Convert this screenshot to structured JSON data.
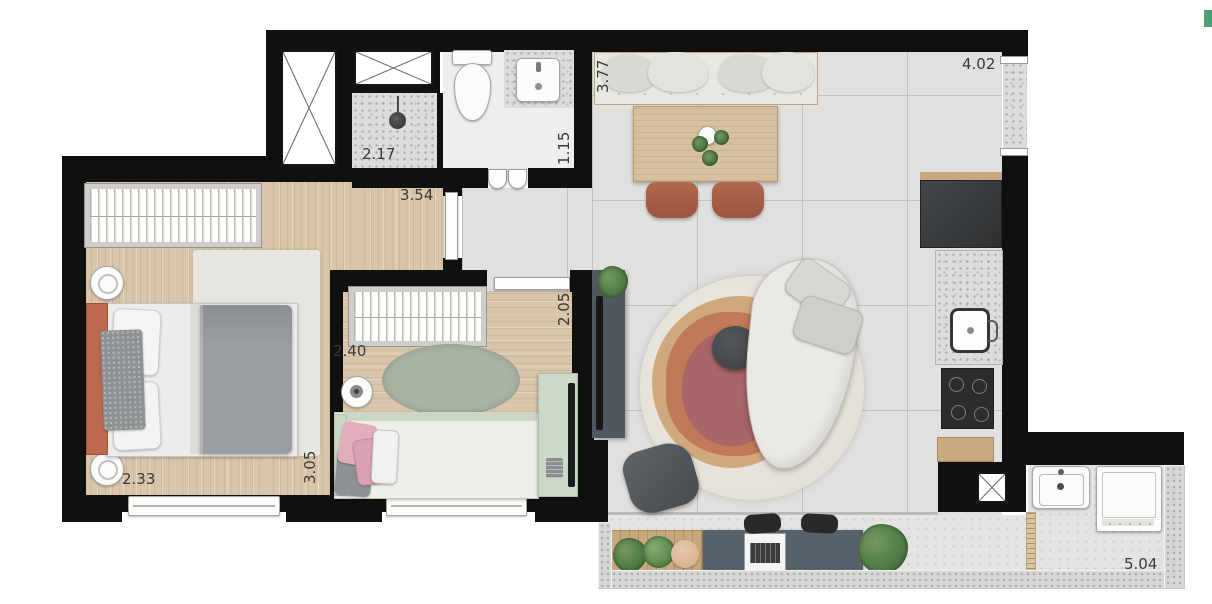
{
  "floor_plan": {
    "type": "apartment-floor-plan-top-view",
    "labels": {
      "shower_width": "2.17",
      "bathroom_width": "1.15",
      "hall_width": "3.54",
      "dining_depth": "3.77",
      "living_width": "4.02",
      "bedroom2_depth": "2.05",
      "bedroom2_width": "2.40",
      "bedroom1_width": "2.33",
      "bedroom1_depth": "3.05",
      "terrace_width": "5.04"
    },
    "colors": {
      "wall": "#101010",
      "wood_floor": "#d9c6aa",
      "tile_floor": "#e1e0de",
      "terracotta_accent": "#b2674e",
      "sage_accent": "#ccd8c8",
      "rug_center": "#a96569",
      "green_tab": "#4f9d73"
    }
  },
  "ui": {
    "green_tab": ""
  }
}
